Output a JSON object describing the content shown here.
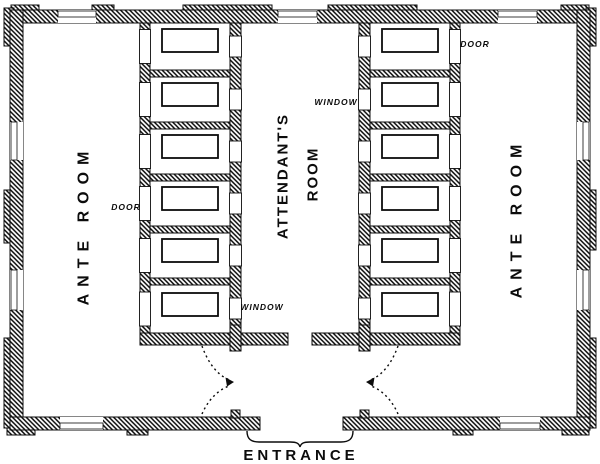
{
  "page": {
    "background": "#ffffff",
    "ink": "#0c0c0c"
  },
  "plan": {
    "left_ante_room": {
      "label": "ANTE ROOM"
    },
    "right_ante_room": {
      "label": "ANTE ROOM"
    },
    "attendants_room": {
      "label_line1": "ATTENDANT'S",
      "label_line2": "ROOM"
    },
    "annotations": {
      "left_door": "DOOR",
      "right_door": "DOOR",
      "lower_window": "WINDOW",
      "upper_window": "WINDOW",
      "entrance": "ENTRANCE"
    },
    "cells": {
      "per_side": 6,
      "sides": 2,
      "slabs_per_cell": 1
    }
  }
}
